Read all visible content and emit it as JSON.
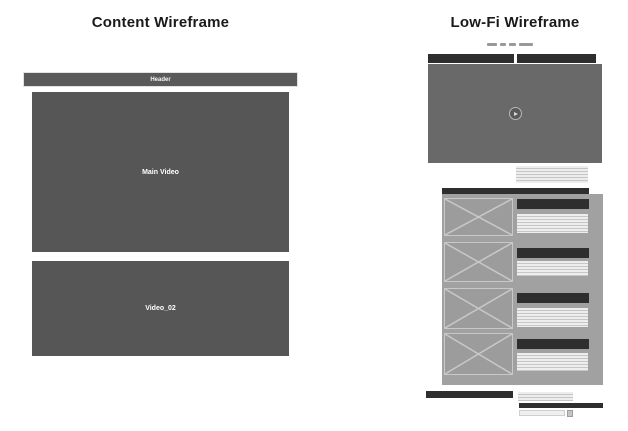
{
  "left_wireframe": {
    "title": "Content Wireframe",
    "header_label": "Header",
    "main_video_label": "Main Video",
    "video_02_label": "Video_02"
  },
  "right_wireframe": {
    "title": "Low-Fi Wireframe",
    "nav_dash_count": 4,
    "list_item_count": 4,
    "play_icon": "play-triangle"
  },
  "colors": {
    "box-gray": "#565656",
    "video-gray": "#696969",
    "bar-dark": "#2e2e2e",
    "panel-gray": "#a1a1a1",
    "placeholder-gray": "#9c9c9c",
    "line-block-bg": "#ededed",
    "line-color": "#c6c6c6",
    "dash-gray": "#999999",
    "title-color": "#1a1a1a"
  }
}
